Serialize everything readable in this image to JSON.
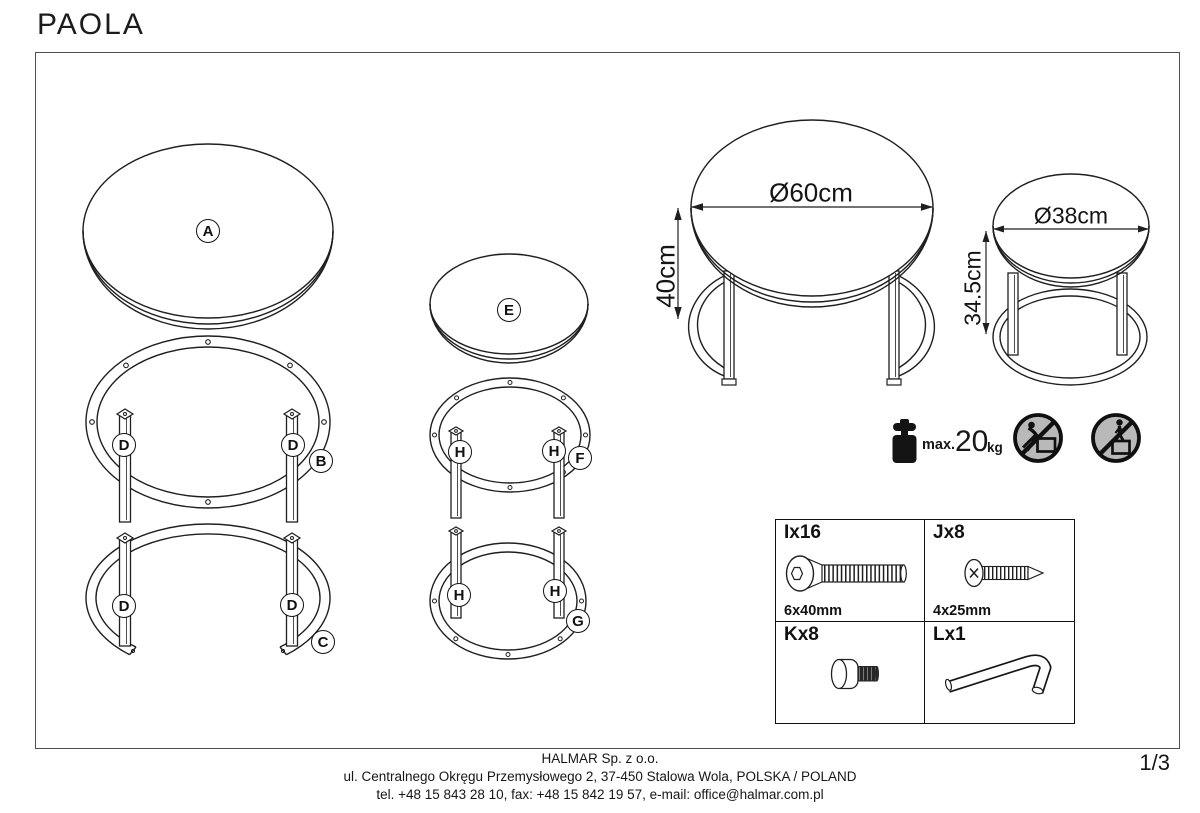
{
  "meta": {
    "title": "PAOLA",
    "page_number": "1/3"
  },
  "part_labels": {
    "A": "A",
    "B": "B",
    "C": "C",
    "D": "D",
    "E": "E",
    "F": "F",
    "G": "G",
    "H": "H"
  },
  "dimensions": {
    "large_table": {
      "diameter": "Ø60cm",
      "height": "40cm"
    },
    "small_table": {
      "diameter": "Ø38cm",
      "height": "34.5cm"
    }
  },
  "load_limit": {
    "label": "max.",
    "value": "20",
    "unit": "kg"
  },
  "hardware": {
    "items": [
      {
        "label": "Ix16",
        "size": "6x40mm",
        "icon": "flat-head-bolt-icon"
      },
      {
        "label": "Jx8",
        "size": "4x25mm",
        "icon": "wood-screw-icon"
      },
      {
        "label": "Kx8",
        "size": "",
        "icon": "connector-bolt-icon"
      },
      {
        "label": "Lx1",
        "size": "",
        "icon": "allen-key-icon"
      }
    ]
  },
  "safety": {
    "icons": [
      "no-leaning-on-table-icon",
      "no-standing-on-table-icon"
    ]
  },
  "footer": {
    "company": "HALMAR Sp. z o.o.",
    "address": "ul. Centralnego Okręgu Przemysłowego 2, 37-450 Stalowa Wola, POLSKA / POLAND",
    "contact": "tel. +48 15 843 28 10, fax: +48 15 842 19 57, e-mail: office@halmar.com.pl"
  },
  "colors": {
    "line": "#1f1f1f",
    "prohibition_fill": "#b9b9b9",
    "accent_black": "#141414"
  }
}
